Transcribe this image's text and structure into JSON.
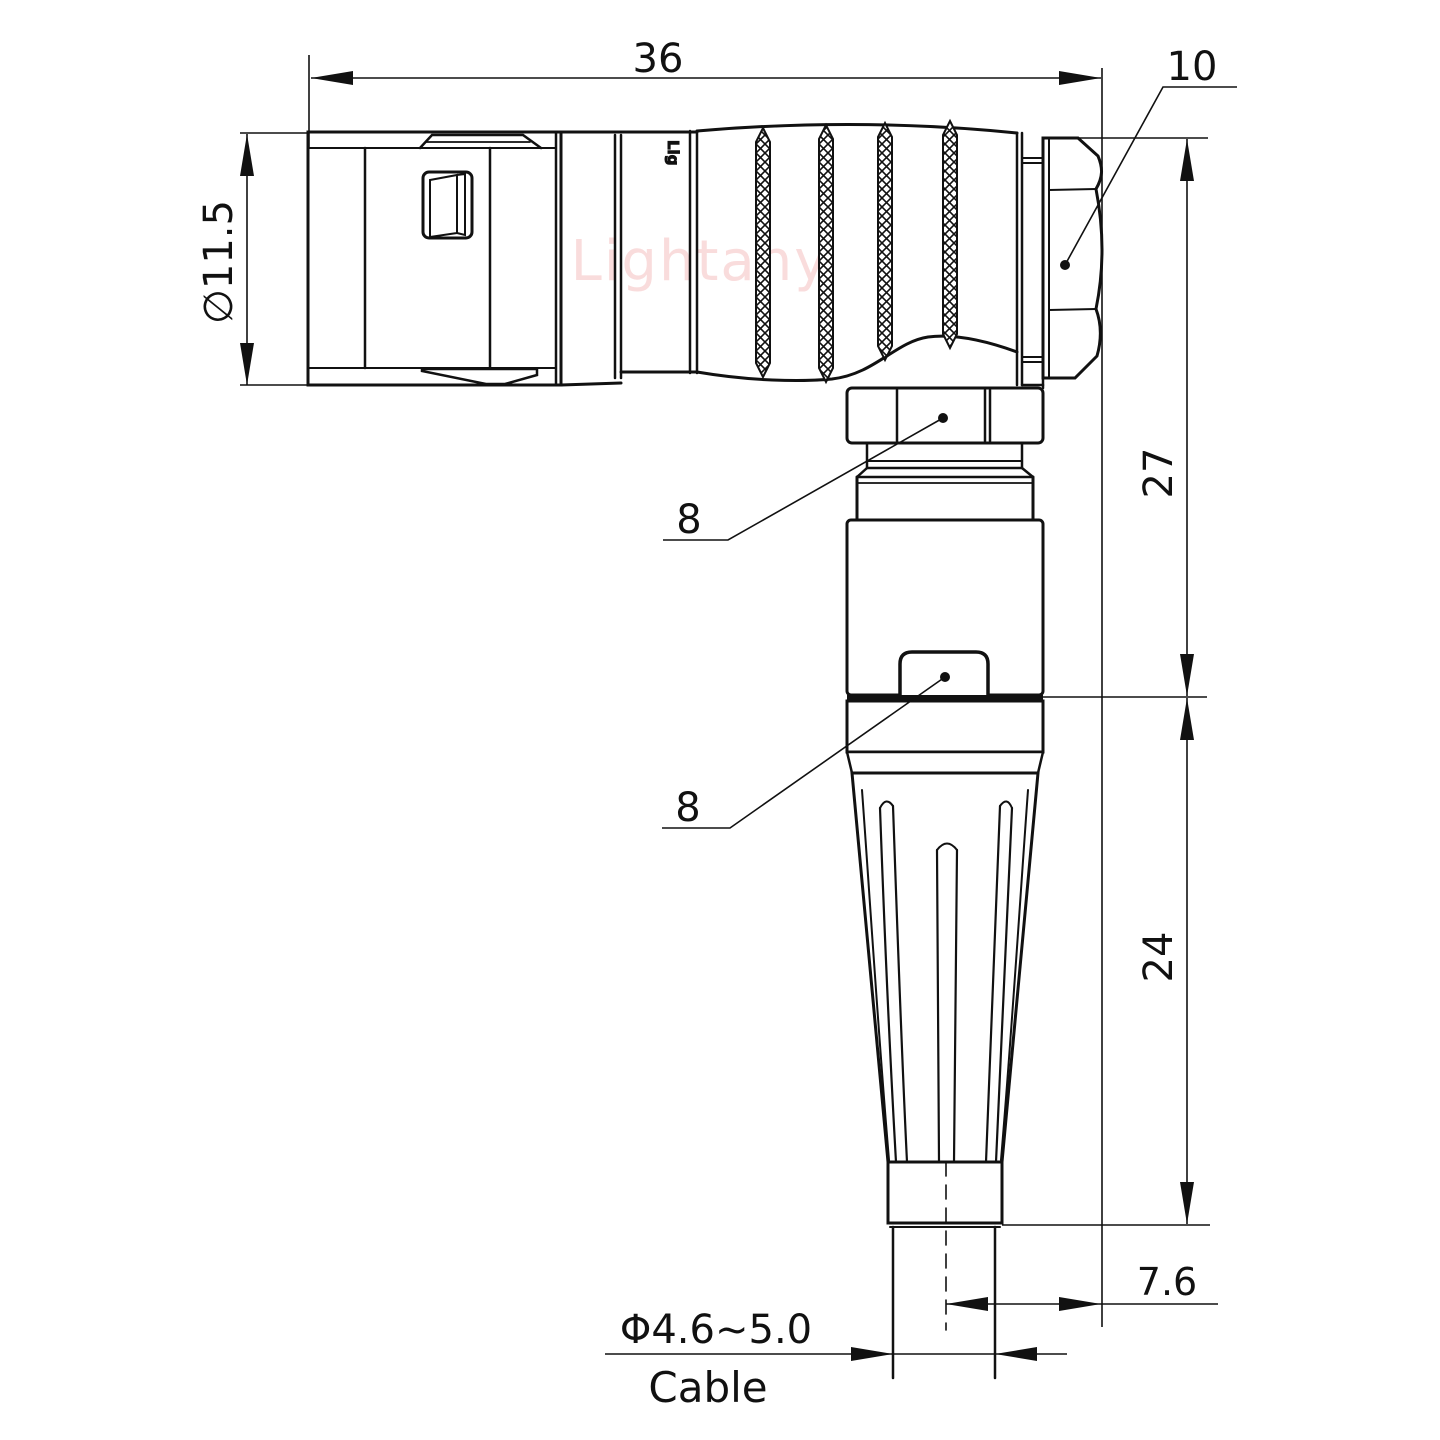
{
  "drawing": {
    "title": "Right-angle push-pull connector with cable strain relief - dimensioned side view",
    "labels": {
      "overall_length": "36",
      "diameter": "∅11.5",
      "nut_size": "10",
      "upper_height": "27",
      "lower_height": "24",
      "hex_callout_upper": "8",
      "hex_callout_lower": "8",
      "cable_offset": "7.6",
      "cable_diameter": "Φ4.6~5.0",
      "cable_word": "Cable"
    },
    "watermark": {
      "text": "Lightany",
      "color": "#f6caca"
    },
    "body_logo": "Lig",
    "colors": {
      "line": "#111111",
      "background": "#ffffff"
    }
  }
}
